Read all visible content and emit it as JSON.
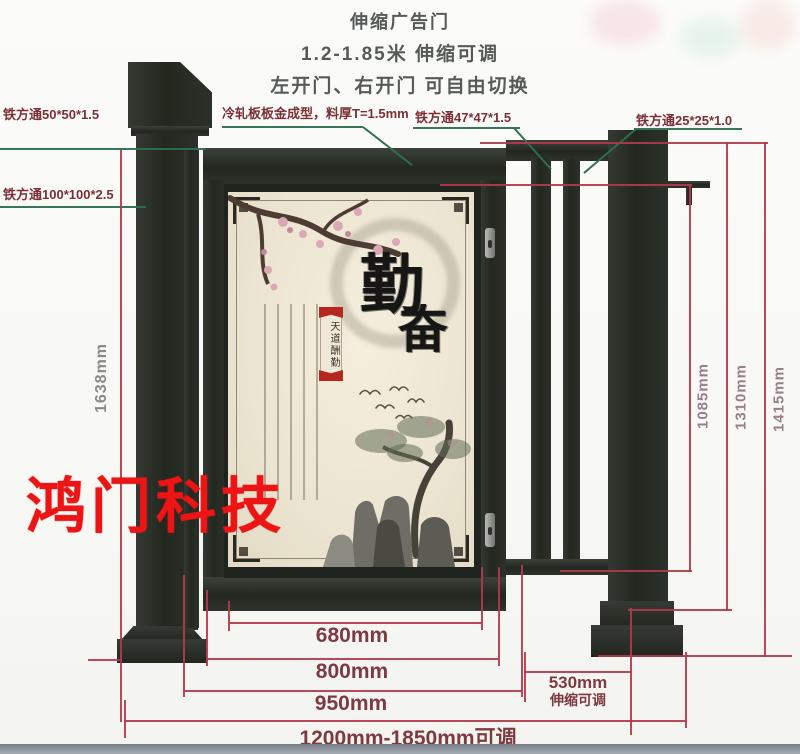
{
  "title": {
    "line1": "伸缩广告门",
    "line2": "1.2-1.85米 伸缩可调",
    "line3": "左开门、右开门 可自由切换"
  },
  "callouts": {
    "tube50": "铁方通50*50*1.5",
    "tube100": "铁方通100*100*2.5",
    "cold_rolled": "冷轧板板金成型，料厚T=1.5mm",
    "tube47": "铁方通47*47*1.5",
    "tube25": "铁方通25*25*1.0"
  },
  "dimensions": {
    "left_total_height": "1638mm",
    "wing_height": "1085mm",
    "beam_height": "1310mm",
    "post_height": "1415mm",
    "panel_width": "680mm",
    "door_width": "800mm",
    "frame_width": "950mm",
    "gap_width": "530mm",
    "gap_note": "伸缩可调",
    "total_width": "1200mm-1850mm可调"
  },
  "watermark": "鸿门科技",
  "artwork": {
    "calligraphy_top": "勤",
    "calligraphy_bottom": "奋",
    "banner": "天道酬勤"
  },
  "colors": {
    "steel_dark": "#23281f",
    "dimension_line_red": "#b13a4b",
    "dimension_text": "#7d3b41",
    "leader_line_green": "#2e6f4e",
    "callout_text": "#7c3036",
    "watermark_red": "#ec1414",
    "panel_cream": "#ebe4d0"
  }
}
